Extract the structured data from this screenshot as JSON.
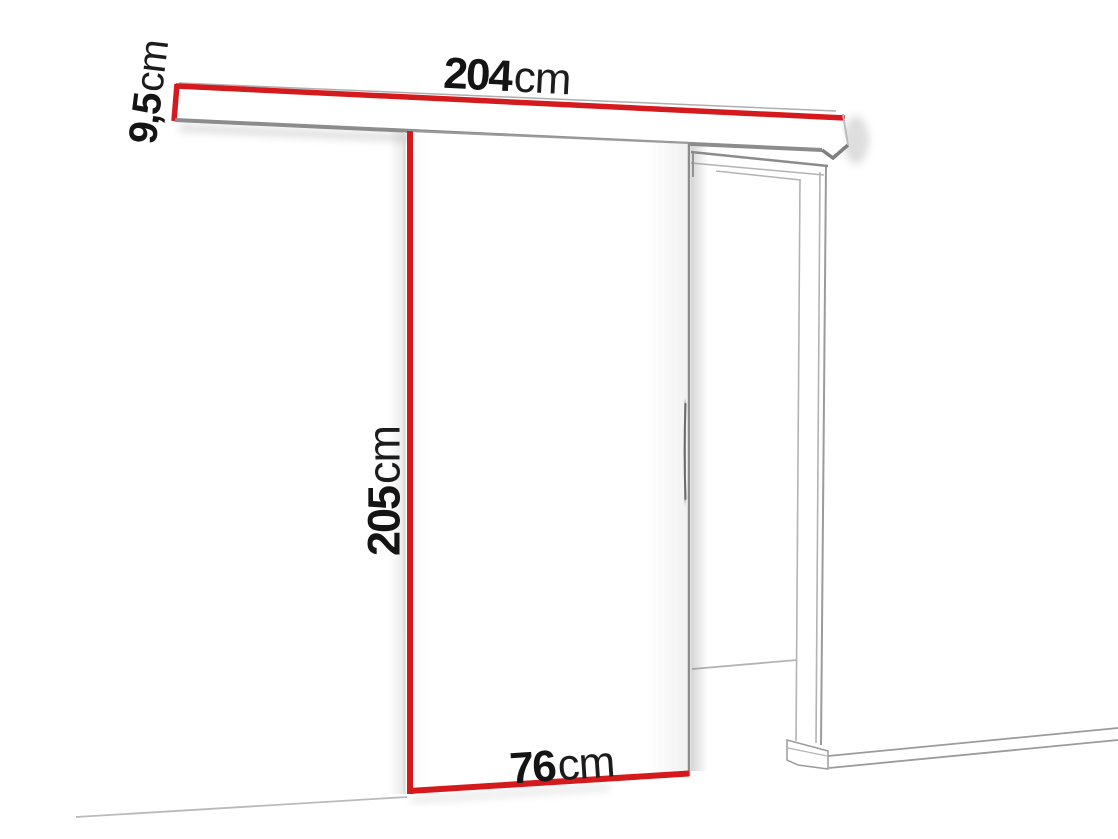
{
  "labels": {
    "rail_width": {
      "value": "204",
      "unit": "cm"
    },
    "rail_height": {
      "value": "9,5",
      "unit": "cm"
    },
    "door_height": {
      "value": "205",
      "unit": "cm"
    },
    "door_width": {
      "value": "76",
      "unit": "cm"
    }
  },
  "colors": {
    "dimension_red": "#d41a1d",
    "frame_gray": "#9b9b9b",
    "shadow_gray": "#8c8c8c",
    "text_black": "#141414",
    "background": "#ffffff"
  }
}
